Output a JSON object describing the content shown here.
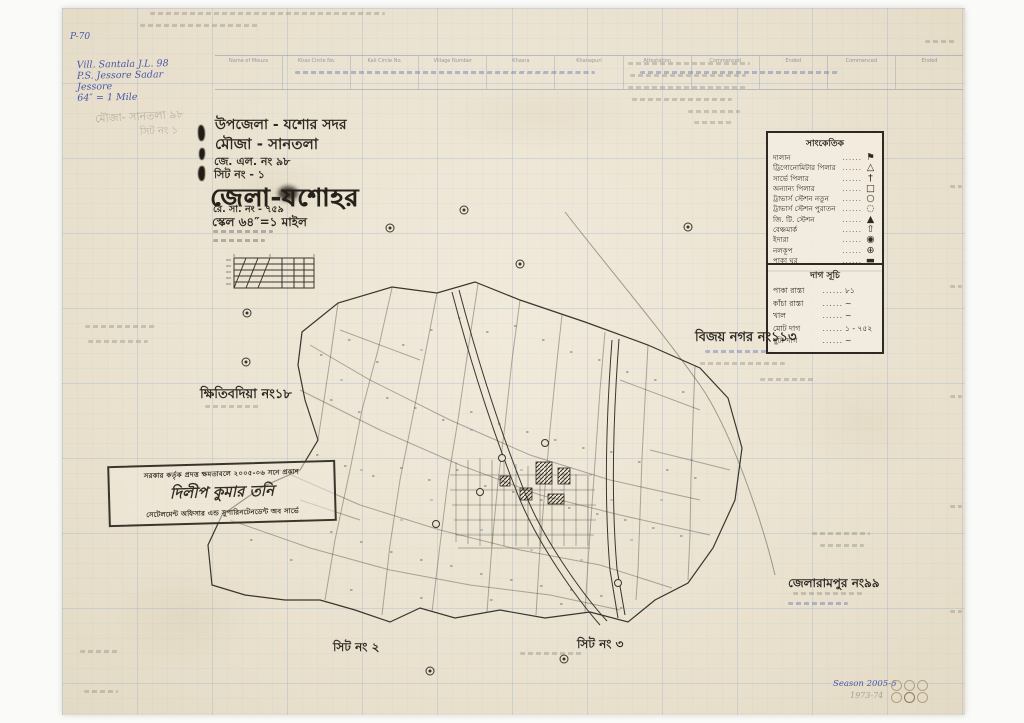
{
  "title_block": {
    "line1": "উপজেলা - যশোর সদর",
    "line2": "মৌজা -  সানতলা",
    "line3": "জে. এল. নং   ৯৮",
    "line4": "সিট নং -   ১",
    "district": "জেলা-যশোহর",
    "re_sa_no": "রে. সা. নং - ৭৫৯",
    "scale": "স্কেল ৬৪″=১ মাইল"
  },
  "header_form": {
    "columns": [
      "Name of Mouza",
      "Khas Circle No.",
      "Kali Circle No.",
      "Village Number",
      "Khasra",
      "Khanapuri",
      "Attestation",
      "Commenced",
      "Ended",
      "Commenced",
      "Ended"
    ]
  },
  "notes": {
    "top_left_blue": [
      "Vill. Santala  J.L.  98",
      "P.S. Jessore Sadar",
      "Jessore",
      "64″ = 1 Mile"
    ],
    "blue_code": "P-70",
    "pencil_mouza": "মৌজা- সানতলা ৯৮",
    "pencil_sheet": "সিট নং ১",
    "season_blue": "Season 2005-6",
    "season_pencil": "1973-74"
  },
  "legend": {
    "title": "সাংকেতিক",
    "dots": "......",
    "items": [
      {
        "label": "দালান",
        "glyph": "⚑",
        "icon": "building-flag"
      },
      {
        "label": "ট্রিগোনোমিটার পিলার",
        "glyph": "△",
        "icon": "trig-pillar"
      },
      {
        "label": "সার্ভে পিলার",
        "glyph": "†",
        "icon": "survey-pillar"
      },
      {
        "label": "অন্যান্য পিলার",
        "glyph": "□",
        "icon": "other-pillar"
      },
      {
        "label": "ট্রাভার্স স্টেশন নতুন",
        "glyph": "○",
        "icon": "traverse-station-new"
      },
      {
        "label": "ট্রাভার্স স্টেশন পুরাতন",
        "glyph": "◌",
        "icon": "traverse-station-old"
      },
      {
        "label": "জি. টি. স্টেশন",
        "glyph": "▲",
        "icon": "gt-station"
      },
      {
        "label": "বেঞ্চমার্ক",
        "glyph": "⇧",
        "icon": "benchmark"
      },
      {
        "label": "ইদারা",
        "glyph": "◉",
        "icon": "well"
      },
      {
        "label": "নলকূপ",
        "glyph": "⊕",
        "icon": "tube-well"
      },
      {
        "label": "পাকা ঘর",
        "glyph": "▬",
        "icon": "pucca-house"
      }
    ]
  },
  "dag_box": {
    "title": "দাগ সূচি",
    "dots": "......",
    "items": [
      {
        "label": "পাকা রাস্তা",
        "value": "৮১"
      },
      {
        "label": "কাঁচা রাস্তা",
        "value": "~"
      },
      {
        "label": "খাল",
        "value": "~"
      },
      {
        "label": "মোট দাগ",
        "value": "১ - ৭৫২"
      },
      {
        "label": "ছুটা দাগ",
        "value": "~"
      }
    ]
  },
  "map_labels": {
    "west_mouza": "ক্ষিতিবদিয়া নং১৮",
    "east_mouza": "বিজয় নগর নং১১৩",
    "southeast_mouza": "জেলারামপুর নং৯৯",
    "sheet2": "সিট নং ২",
    "sheet3": "সিট নং ৩"
  },
  "stamp": {
    "line1": "সরকার কর্তৃক প্রদত্ত ক্ষমতাবলে ২০০৫-০৬ সনে প্রকাশ",
    "signature": "দিলীপ কুমার তনি",
    "line3": "সেটেলমেন্ট অফিসার এন্ড সুপারিনটেনডেন্ট অব সার্ভে"
  }
}
